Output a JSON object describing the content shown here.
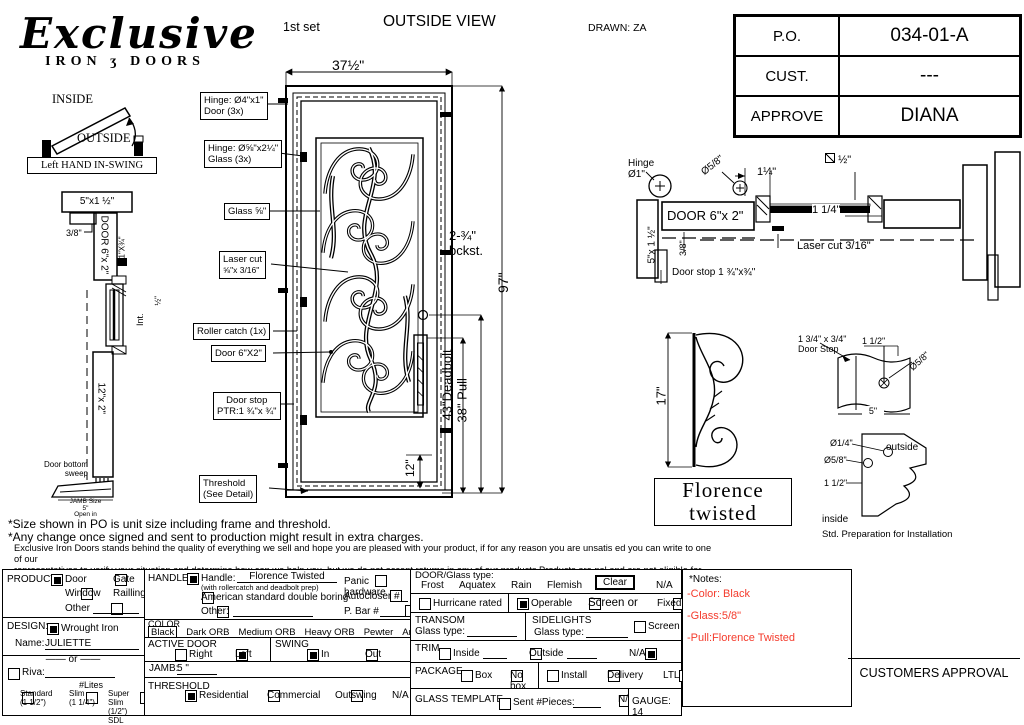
{
  "theme": {
    "notes_red": "#f43b2c"
  },
  "header": {
    "logo_script": "Exclusive",
    "logo_iron": "IRON",
    "logo_glyph": "ʒ",
    "logo_doors": "DOORS",
    "set_label": "1st set",
    "view_title": "OUTSIDE VIEW",
    "drawn": "DRAWN: ZA"
  },
  "po_table": {
    "rows": [
      {
        "label": "P.O.",
        "value": "034-01-A"
      },
      {
        "label": "CUST.",
        "value": "---"
      },
      {
        "label": "APPROVE",
        "value": "DIANA"
      }
    ]
  },
  "swing": {
    "inside": "INSIDE",
    "outside": "OUTSIDE",
    "caption": "Left HAND IN-SWING"
  },
  "side_profile": {
    "size_top": "5\"x1 ½\"",
    "dim_38": "3/8\"",
    "door": "DOOR 6\"x 2\"",
    "strip": "1\"X¾\"",
    "half": "½\"",
    "int": "Int.",
    "rail": "12\"x 2\"",
    "sweep1": "Door bottom",
    "sweep2": "sweep",
    "jamb1": "JAMB Size",
    "jamb2": "5\"",
    "jamb3": "Open in"
  },
  "elevation": {
    "width": "37½\"",
    "backset1": "2-¾\"",
    "backset2": "bckst.",
    "height": "97\"",
    "pull": "38\" Pull",
    "deadbolt": "43\"Deadbolt",
    "bottom": "12\""
  },
  "callouts": [
    {
      "l1": "Hinge: Ø4\"x1\"",
      "l2": "Door (3x)"
    },
    {
      "l1": "Hinge: Ø⅝\"x2¼\"",
      "l2": "Glass (3x)"
    },
    {
      "l1": "Glass ⅝\"",
      "l2": ""
    },
    {
      "l1": "Laser cut",
      "l2": "⅝\"x 3/16\""
    },
    {
      "l1": "Roller catch  (1x)",
      "l2": ""
    },
    {
      "l1": "Door  6\"X2\"",
      "l2": ""
    },
    {
      "l1": "Door stop",
      "l2": "PTR:1 ¾\"x ¾\""
    },
    {
      "l1": "Threshold",
      "l2": "(See Detail)"
    }
  ],
  "cross_section": {
    "hinge1": "Hinge",
    "hinge2": "Ø1\"",
    "dia58": "Ø5/8\"",
    "dim114a": "1¼\"",
    "sq_half": "½\"",
    "door": "DOOR 6\"x 2\"",
    "dim114b": "1 1/4\"",
    "jamb": "5\"x 1 ½\"",
    "dim38": "3/8\"",
    "laser": "Laser cut 3/16\"",
    "doorstop": "Door stop 1 ¾\"x¾\""
  },
  "scroll_detail": {
    "dim": "17\"",
    "name1": "Florence",
    "name2": "twisted"
  },
  "doorstop_detail": {
    "l1": "1 3/4\" x 3/4\"",
    "l2": "Door Stop",
    "dim112": "1 1/2\"",
    "dia58": "Ø5/8\"",
    "dim5": "5\""
  },
  "prep_detail": {
    "dia14": "Ø1/4\"",
    "dia58": "Ø5/8\"",
    "dim112": "1 1/2\"",
    "outside": "outside",
    "inside": "inside",
    "caption": "Std. Preparation for Installation"
  },
  "disclaimer": {
    "line1": "*Size shown in PO is unit size including frame and threshold.",
    "line2": "*Any change once signed and sent to production might result in extra charges.",
    "para1": "Exclusive Iron Doors stands behind the quality of everything we sell and hope you are pleased with your product, if for any reason you are unsatis   ed you can write to one of our",
    "para2": "representatives to verify your situation and determine how can we help you, but we do not accept returns in any of our products.Products are    nal and are not eligible for returns, changes",
    "para3": "or alterations.By signing you agree to our terms and conditions, delivery pdf and forms of payment. *Doors measurements do not include the gaps between jambs"
  },
  "form": {
    "product": {
      "title": "PRODUCT:",
      "door": {
        "label": "Door",
        "checked": true
      },
      "gate": {
        "label": "Gate",
        "checked": false
      },
      "window": {
        "label": "Window",
        "checked": false
      },
      "railling": {
        "label": "Railling",
        "checked": false
      },
      "other": {
        "label": "Other",
        "checked": false
      }
    },
    "design": {
      "title": "DESIGN:",
      "wrought": {
        "label": "Wrought Iron",
        "checked": true
      },
      "name_label": "Name:",
      "name_value": "JULIETTE",
      "or": "or",
      "riva": {
        "label": "Riva:",
        "checked": false
      },
      "lites": "#Lites",
      "standard": {
        "label": "Standard",
        "sub": "(1 1/2\")",
        "checked": false
      },
      "slim": {
        "label": "Slim",
        "sub": "(1 1/4\")",
        "checked": false
      },
      "super_slim": {
        "label": "Super Slim",
        "sub": "(1/2\") SDL",
        "checked": false
      }
    },
    "handle": {
      "title": "HANDLE",
      "handle": {
        "label": "Handle:",
        "checked": true
      },
      "value": "Florence Twisted",
      "sub": "(with rollercatch and deadbolt prep)",
      "american": {
        "label": "American standard double boring",
        "checked": false
      },
      "other": {
        "label": "Other:",
        "checked": false
      },
      "panic": {
        "label": "Panic hardware",
        "checked": false
      },
      "autocloser": {
        "label": "Autocloser #",
        "checked": false
      },
      "pbar": {
        "label": "P. Bar #",
        "checked": false
      }
    },
    "color": {
      "title": "COLOR",
      "selected": "Black",
      "options": [
        "Dark ORB",
        "Medium ORB",
        "Heavy ORB",
        "Pewter",
        "Antique gold"
      ]
    },
    "active_door": {
      "title": "ACTIVE DOOR",
      "right": {
        "label": "Right",
        "checked": false
      },
      "left": {
        "label": "Left",
        "checked": true
      }
    },
    "swing": {
      "title": "SWING",
      "in": {
        "label": "In",
        "checked": true
      },
      "out": {
        "label": "Out",
        "checked": false
      }
    },
    "jamb": {
      "title": "JAMB:",
      "value": "5 \""
    },
    "threshold": {
      "title": "THRESHOLD",
      "residential": {
        "label": "Residential",
        "checked": true
      },
      "commercial": {
        "label": "Commercial",
        "checked": false
      },
      "outswing": {
        "label": "Outswing",
        "checked": false
      },
      "na": {
        "label": "N/A",
        "checked": false
      }
    },
    "glass": {
      "title": "DOOR/Glass type:",
      "options": [
        "Frost",
        "Aquatex",
        "Rain",
        "Flemish"
      ],
      "selected": "Clear",
      "na": "N/A"
    },
    "hurricane": {
      "label": "Hurricane rated",
      "checked": false
    },
    "operable": {
      "label": "Operable",
      "checked": true
    },
    "screen_or": {
      "label": "Screen or",
      "checked": false
    },
    "fixed": {
      "label": "Fixed",
      "checked": false
    },
    "transom": {
      "title": "TRANSOM",
      "glass_label": "Glass type:"
    },
    "sidelights": {
      "title": "SIDELIGHTS",
      "glass_label": "Glass type:",
      "screen": {
        "label": "Screen",
        "checked": false
      }
    },
    "trim": {
      "title": "TRIM",
      "inside": {
        "label": "Inside",
        "checked": false
      },
      "outside": {
        "label": "Outside",
        "checked": false
      },
      "na": {
        "label": "N/A",
        "checked": true
      }
    },
    "package": {
      "title": "PACKAGE",
      "box": {
        "label": "Box",
        "checked": false
      },
      "nobox": {
        "label": "No box",
        "checked": false
      },
      "install": {
        "label": "Install",
        "checked": false
      },
      "delivery": {
        "label": "Delivery",
        "checked": false
      },
      "ltl": {
        "label": "LTL",
        "checked": false
      }
    },
    "glass_template": {
      "title": "GLASS TEMPLATE",
      "sent": {
        "label": "Sent #Pieces:",
        "checked": false
      },
      "na": {
        "label": "N/A",
        "checked": false
      },
      "gauge": "GAUGE: 14"
    }
  },
  "notes": {
    "title": "*Notes:",
    "items": [
      "-Color: Black",
      "-Glass:5/8\"",
      "-Pull:Florence Twisted"
    ]
  },
  "approval": {
    "label": "CUSTOMERS APPROVAL"
  }
}
